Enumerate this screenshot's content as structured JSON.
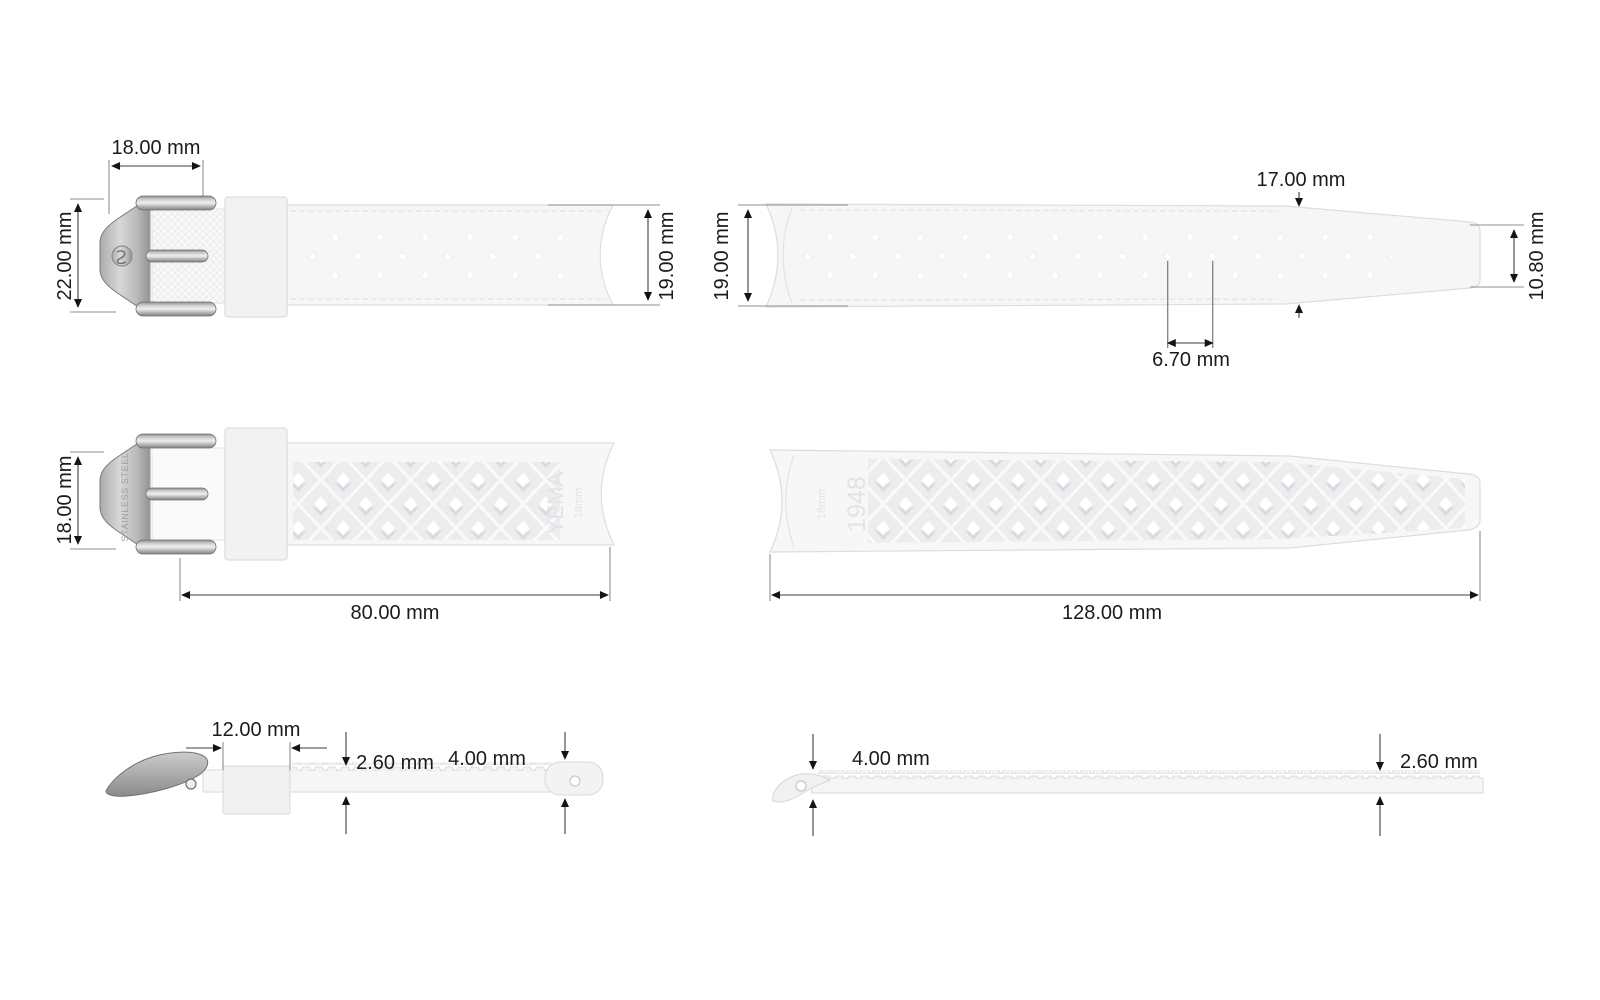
{
  "views": {
    "buckle_flat": {
      "label": "short strap with buckle, flat view",
      "buckle_width": "18.00 mm",
      "buckle_height": "22.00 mm",
      "strap_width": "19.00 mm"
    },
    "long_flat": {
      "label": "long strap, flat view",
      "strap_width": "19.00 mm",
      "taper_width": "17.00 mm",
      "tip_width": "10.80 mm",
      "hole_spacing": "6.70 mm"
    },
    "buckle_back": {
      "label": "short strap with buckle, back view",
      "lug_width": "18.00 mm",
      "length": "80.00 mm",
      "buckle_marking": "STAINLESS STEEL",
      "brand_marking": "YEMA",
      "size_marking": "18mm"
    },
    "long_back": {
      "label": "long strap, back view",
      "length": "128.00 mm",
      "brand_marking": "1948",
      "size_marking": "18mm"
    },
    "buckle_side": {
      "label": "short strap with buckle, side profile",
      "keeper_width": "12.00 mm",
      "thickness": "2.60 mm",
      "end_thickness": "4.00 mm"
    },
    "long_side": {
      "label": "long strap, side profile",
      "end_thickness": "4.00 mm",
      "thickness": "2.60 mm"
    }
  },
  "colors": {
    "background": "#ffffff",
    "strap_fill": "#f6f6f7",
    "strap_outline": "#d9dadb",
    "pattern_fill": "#ebedef",
    "dimension_line": "#3e3e3e",
    "extension_line": "#8f8f90",
    "arrow": "#141414",
    "text": "#1b1b1b",
    "metal_dark": "#828282",
    "metal_light": "#efefef"
  }
}
